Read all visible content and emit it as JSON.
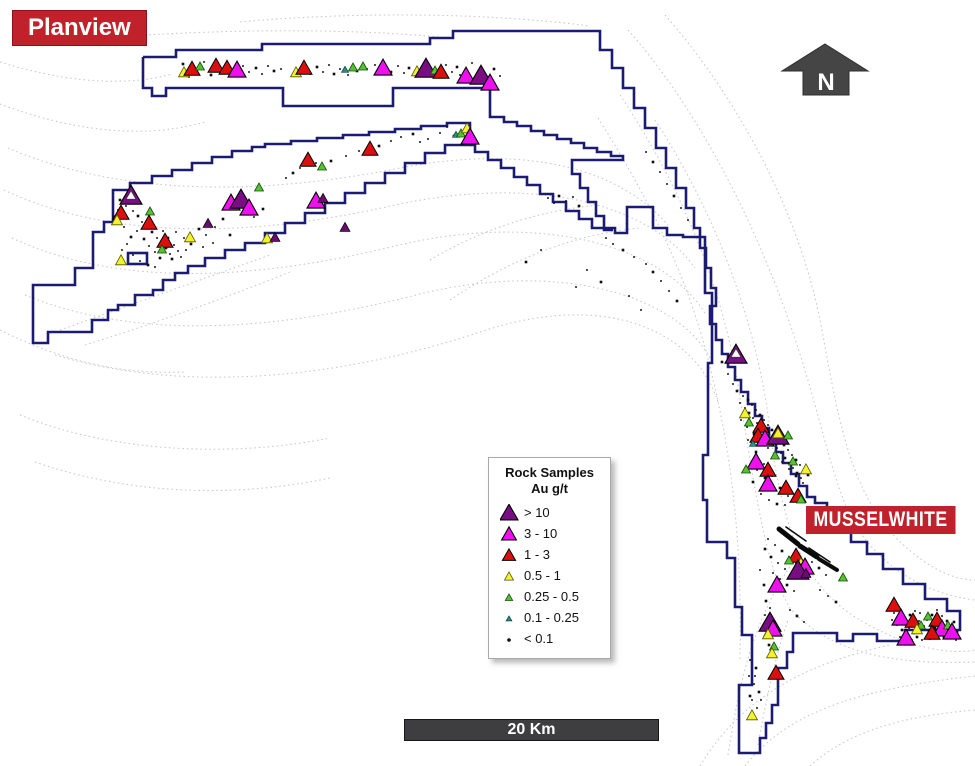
{
  "title_badge": {
    "text": "Planview",
    "bg": "#c0222b",
    "fg": "#ffffff"
  },
  "mine_badge": {
    "text": "MUSSELWHITE",
    "bg": "#c0222b",
    "fg": "#ffffff"
  },
  "north_arrow": {
    "label": "N",
    "color": "#454545"
  },
  "scale_bar": {
    "label": "20 Km",
    "bg": "#3e3e40",
    "fg": "#ffffff"
  },
  "legend": {
    "title_line1": "Rock Samples",
    "title_line2": "Au g/t",
    "items": [
      {
        "label": "> 10",
        "class": "p"
      },
      {
        "label": "3 - 10",
        "class": "m"
      },
      {
        "label": "1 - 3",
        "class": "r"
      },
      {
        "label": "0.5 - 1",
        "class": "y"
      },
      {
        "label": "0.25 - 0.5",
        "class": "g"
      },
      {
        "label": "0.1 - 0.25",
        "class": "t"
      },
      {
        "label": "< 0.1",
        "class": "d"
      }
    ]
  },
  "map_data": {
    "boundary_color": "#1b1b72",
    "trail_color": "#c7c7d0",
    "classes": {
      "p": {
        "fill": "#7b0d84",
        "stroke": "#000000"
      },
      "ps": {
        "fill": "#6a0b72",
        "stroke": "#000000"
      },
      "m": {
        "fill": "#ee10ee",
        "stroke": "#000000"
      },
      "r": {
        "fill": "#dd0e0e",
        "stroke": "#000000"
      },
      "y": {
        "fill": "#f2f22e",
        "stroke": "#555500"
      },
      "g": {
        "fill": "#56c232",
        "stroke": "#134f08"
      },
      "t": {
        "fill": "#2a8f86",
        "stroke": "#093f3c"
      },
      "w": {
        "fill": "#fafafa",
        "stroke": "#333333"
      },
      "d": {
        "fill": "#0d0d0d",
        "stroke": "#0d0d0d"
      }
    },
    "samples": [
      [
        "y",
        184,
        73
      ],
      [
        "r",
        192,
        70
      ],
      [
        "g",
        200,
        67
      ],
      [
        "r",
        216,
        67
      ],
      [
        "r",
        227,
        69
      ],
      [
        "m",
        237,
        71
      ],
      [
        "y",
        296,
        73
      ],
      [
        "r",
        304,
        69
      ],
      [
        "t",
        345,
        70
      ],
      [
        "g",
        353,
        68
      ],
      [
        "g",
        363,
        67
      ],
      [
        "m",
        383,
        69
      ],
      [
        "y",
        417,
        72
      ],
      [
        "p",
        426,
        70
      ],
      [
        "g",
        435,
        71
      ],
      [
        "r",
        441,
        73
      ],
      [
        "m",
        466,
        77
      ],
      [
        "p",
        481,
        77
      ],
      [
        "m",
        490,
        84
      ],
      [
        "t",
        456,
        135
      ],
      [
        "g",
        461,
        134
      ],
      [
        "y",
        467,
        129
      ],
      [
        "m",
        470,
        138
      ],
      [
        "r",
        308,
        161
      ],
      [
        "g",
        322,
        167
      ],
      [
        "r",
        370,
        150
      ],
      [
        "g",
        259,
        188
      ],
      [
        "p",
        131,
        197
      ],
      [
        "w",
        131,
        196
      ],
      [
        "r",
        121,
        214
      ],
      [
        "y",
        117,
        221
      ],
      [
        "g",
        150,
        212
      ],
      [
        "r",
        149,
        224
      ],
      [
        "r",
        165,
        242
      ],
      [
        "g",
        162,
        250
      ],
      [
        "y",
        121,
        261
      ],
      [
        "y",
        190,
        238
      ],
      [
        "ps",
        208,
        224
      ],
      [
        "m",
        231,
        204
      ],
      [
        "p",
        241,
        201
      ],
      [
        "m",
        249,
        209
      ],
      [
        "m",
        316,
        202
      ],
      [
        "ps",
        323,
        199
      ],
      [
        "y",
        267,
        239
      ],
      [
        "ps",
        275,
        238
      ],
      [
        "ps",
        345,
        228
      ],
      [
        "p",
        736,
        356
      ],
      [
        "w",
        736,
        354
      ],
      [
        "y",
        745,
        414
      ],
      [
        "g",
        749,
        423
      ],
      [
        "r",
        761,
        427
      ],
      [
        "r",
        758,
        437
      ],
      [
        "m",
        765,
        440
      ],
      [
        "t",
        753,
        444
      ],
      [
        "p",
        778,
        437
      ],
      [
        "y",
        778,
        434
      ],
      [
        "g",
        788,
        436
      ],
      [
        "m",
        756,
        463
      ],
      [
        "g",
        775,
        456
      ],
      [
        "r",
        768,
        471
      ],
      [
        "g",
        793,
        462
      ],
      [
        "y",
        806,
        470
      ],
      [
        "m",
        768,
        485
      ],
      [
        "r",
        786,
        489
      ],
      [
        "r",
        798,
        497
      ],
      [
        "g",
        801,
        500
      ],
      [
        "g",
        746,
        470
      ],
      [
        "r",
        796,
        557
      ],
      [
        "g",
        789,
        561
      ],
      [
        "y",
        801,
        564
      ],
      [
        "m",
        805,
        568
      ],
      [
        "p",
        798,
        572
      ],
      [
        "ps",
        806,
        574
      ],
      [
        "m",
        777,
        586
      ],
      [
        "g",
        843,
        578
      ],
      [
        "p",
        770,
        624
      ],
      [
        "m",
        773,
        630
      ],
      [
        "y",
        768,
        635
      ],
      [
        "g",
        774,
        647
      ],
      [
        "y",
        772,
        654
      ],
      [
        "r",
        776,
        674
      ],
      [
        "y",
        752,
        716
      ],
      [
        "r",
        894,
        606
      ],
      [
        "m",
        901,
        619
      ],
      [
        "r",
        913,
        622
      ],
      [
        "g",
        921,
        626
      ],
      [
        "g",
        928,
        617
      ],
      [
        "r",
        937,
        621
      ],
      [
        "m",
        942,
        630
      ],
      [
        "g",
        948,
        626
      ],
      [
        "m",
        952,
        633
      ],
      [
        "m",
        906,
        639
      ],
      [
        "y",
        917,
        630
      ],
      [
        "r",
        932,
        634
      ]
    ],
    "dots": [
      [
        183,
        64
      ],
      [
        189,
        77
      ],
      [
        204,
        62
      ],
      [
        211,
        75
      ],
      [
        243,
        66
      ],
      [
        249,
        72
      ],
      [
        256,
        68
      ],
      [
        262,
        74
      ],
      [
        268,
        66
      ],
      [
        274,
        71
      ],
      [
        281,
        69
      ],
      [
        310,
        74
      ],
      [
        317,
        67
      ],
      [
        323,
        72
      ],
      [
        329,
        65
      ],
      [
        334,
        74
      ],
      [
        340,
        69
      ],
      [
        348,
        75
      ],
      [
        357,
        71
      ],
      [
        367,
        69
      ],
      [
        375,
        65
      ],
      [
        391,
        72
      ],
      [
        398,
        66
      ],
      [
        404,
        73
      ],
      [
        409,
        68
      ],
      [
        446,
        65
      ],
      [
        452,
        72
      ],
      [
        457,
        67
      ],
      [
        460,
        75
      ],
      [
        472,
        63
      ],
      [
        494,
        69
      ],
      [
        500,
        76
      ],
      [
        300,
        168
      ],
      [
        293,
        173
      ],
      [
        286,
        178
      ],
      [
        316,
        163
      ],
      [
        331,
        161
      ],
      [
        346,
        156
      ],
      [
        359,
        151
      ],
      [
        379,
        146
      ],
      [
        391,
        141
      ],
      [
        401,
        137
      ],
      [
        413,
        134
      ],
      [
        440,
        133
      ],
      [
        447,
        127
      ],
      [
        454,
        136
      ],
      [
        428,
        139
      ],
      [
        420,
        142
      ],
      [
        120,
        200
      ],
      [
        126,
        206
      ],
      [
        133,
        211
      ],
      [
        138,
        216
      ],
      [
        142,
        222
      ],
      [
        146,
        227
      ],
      [
        152,
        232
      ],
      [
        157,
        238
      ],
      [
        161,
        243
      ],
      [
        166,
        248
      ],
      [
        170,
        254
      ],
      [
        137,
        231
      ],
      [
        131,
        237
      ],
      [
        127,
        244
      ],
      [
        122,
        250
      ],
      [
        144,
        239
      ],
      [
        149,
        246
      ],
      [
        155,
        252
      ],
      [
        160,
        258
      ],
      [
        133,
        255
      ],
      [
        140,
        261
      ],
      [
        148,
        265
      ],
      [
        155,
        267
      ],
      [
        118,
        210
      ],
      [
        114,
        217
      ],
      [
        124,
        227
      ],
      [
        163,
        231
      ],
      [
        168,
        238
      ],
      [
        174,
        245
      ],
      [
        178,
        251
      ],
      [
        172,
        259
      ],
      [
        181,
        257
      ],
      [
        186,
        250
      ],
      [
        191,
        244
      ],
      [
        176,
        232
      ],
      [
        184,
        238
      ],
      [
        199,
        229
      ],
      [
        206,
        235
      ],
      [
        215,
        227
      ],
      [
        223,
        219
      ],
      [
        248,
        211
      ],
      [
        254,
        217
      ],
      [
        263,
        209
      ],
      [
        203,
        247
      ],
      [
        213,
        243
      ],
      [
        230,
        235
      ],
      [
        548,
        198
      ],
      [
        554,
        203
      ],
      [
        559,
        196
      ],
      [
        566,
        201
      ],
      [
        573,
        197
      ],
      [
        579,
        206
      ],
      [
        606,
        238
      ],
      [
        613,
        244
      ],
      [
        623,
        250
      ],
      [
        634,
        257
      ],
      [
        646,
        264
      ],
      [
        653,
        272
      ],
      [
        661,
        281
      ],
      [
        669,
        291
      ],
      [
        677,
        301
      ],
      [
        641,
        310
      ],
      [
        629,
        296
      ],
      [
        601,
        282
      ],
      [
        587,
        270
      ],
      [
        576,
        287
      ],
      [
        526,
        262
      ],
      [
        541,
        250
      ],
      [
        646,
        152
      ],
      [
        653,
        162
      ],
      [
        660,
        172
      ],
      [
        667,
        184
      ],
      [
        674,
        196
      ],
      [
        681,
        208
      ],
      [
        688,
        220
      ],
      [
        722,
        362
      ],
      [
        728,
        374
      ],
      [
        733,
        384
      ],
      [
        737,
        391
      ],
      [
        743,
        396
      ],
      [
        740,
        403
      ],
      [
        748,
        400
      ],
      [
        745,
        408
      ],
      [
        752,
        405
      ],
      [
        749,
        413
      ],
      [
        756,
        410
      ],
      [
        753,
        418
      ],
      [
        760,
        415
      ],
      [
        757,
        423
      ],
      [
        764,
        420
      ],
      [
        761,
        428
      ],
      [
        768,
        425
      ],
      [
        765,
        433
      ],
      [
        772,
        430
      ],
      [
        769,
        438
      ],
      [
        776,
        435
      ],
      [
        773,
        443
      ],
      [
        780,
        440
      ],
      [
        777,
        448
      ],
      [
        784,
        445
      ],
      [
        781,
        453
      ],
      [
        788,
        450
      ],
      [
        785,
        458
      ],
      [
        792,
        455
      ],
      [
        789,
        463
      ],
      [
        796,
        460
      ],
      [
        793,
        468
      ],
      [
        800,
        465
      ],
      [
        797,
        473
      ],
      [
        804,
        470
      ],
      [
        801,
        478
      ],
      [
        808,
        475
      ],
      [
        741,
        420
      ],
      [
        747,
        427
      ],
      [
        754,
        434
      ],
      [
        761,
        441
      ],
      [
        768,
        448
      ],
      [
        775,
        455
      ],
      [
        782,
        462
      ],
      [
        789,
        469
      ],
      [
        796,
        476
      ],
      [
        803,
        483
      ],
      [
        748,
        440
      ],
      [
        756,
        452
      ],
      [
        764,
        464
      ],
      [
        772,
        476
      ],
      [
        780,
        488
      ],
      [
        788,
        496
      ],
      [
        745,
        470
      ],
      [
        753,
        482
      ],
      [
        761,
        494
      ],
      [
        769,
        500
      ],
      [
        777,
        504
      ],
      [
        785,
        505
      ],
      [
        757,
        470
      ],
      [
        765,
        478
      ],
      [
        768,
        539
      ],
      [
        775,
        545
      ],
      [
        782,
        551
      ],
      [
        789,
        557
      ],
      [
        796,
        563
      ],
      [
        771,
        557
      ],
      [
        778,
        563
      ],
      [
        785,
        569
      ],
      [
        765,
        549
      ],
      [
        773,
        573
      ],
      [
        780,
        579
      ],
      [
        787,
        585
      ],
      [
        794,
        591
      ],
      [
        812,
        562
      ],
      [
        819,
        568
      ],
      [
        826,
        575
      ],
      [
        790,
        610
      ],
      [
        797,
        616
      ],
      [
        804,
        622
      ],
      [
        760,
        570
      ],
      [
        764,
        585
      ],
      [
        820,
        590
      ],
      [
        828,
        596
      ],
      [
        836,
        602
      ],
      [
        889,
        608
      ],
      [
        894,
        613
      ],
      [
        899,
        618
      ],
      [
        904,
        623
      ],
      [
        909,
        628
      ],
      [
        914,
        633
      ],
      [
        919,
        621
      ],
      [
        924,
        626
      ],
      [
        929,
        631
      ],
      [
        934,
        636
      ],
      [
        939,
        624
      ],
      [
        944,
        629
      ],
      [
        949,
        634
      ],
      [
        953,
        627
      ],
      [
        957,
        632
      ],
      [
        892,
        620
      ],
      [
        897,
        625
      ],
      [
        902,
        630
      ],
      [
        907,
        635
      ],
      [
        912,
        640
      ],
      [
        917,
        637
      ],
      [
        922,
        640
      ],
      [
        927,
        620
      ],
      [
        932,
        615
      ],
      [
        937,
        610
      ],
      [
        942,
        616
      ],
      [
        947,
        621
      ],
      [
        951,
        638
      ],
      [
        956,
        640
      ],
      [
        944,
        637
      ],
      [
        900,
        637
      ],
      [
        905,
        640
      ],
      [
        910,
        615
      ],
      [
        915,
        611
      ],
      [
        920,
        613
      ],
      [
        935,
        628
      ],
      [
        940,
        633
      ],
      [
        949,
        627
      ],
      [
        954,
        622
      ],
      [
        930,
        639
      ],
      [
        750,
        660
      ],
      [
        756,
        668
      ],
      [
        749,
        676
      ],
      [
        754,
        684
      ],
      [
        759,
        692
      ],
      [
        752,
        700
      ],
      [
        757,
        708
      ],
      [
        750,
        696
      ],
      [
        761,
        700
      ],
      [
        755,
        676
      ],
      [
        766,
        601
      ],
      [
        770,
        608
      ],
      [
        765,
        615
      ],
      [
        769,
        645
      ]
    ]
  }
}
